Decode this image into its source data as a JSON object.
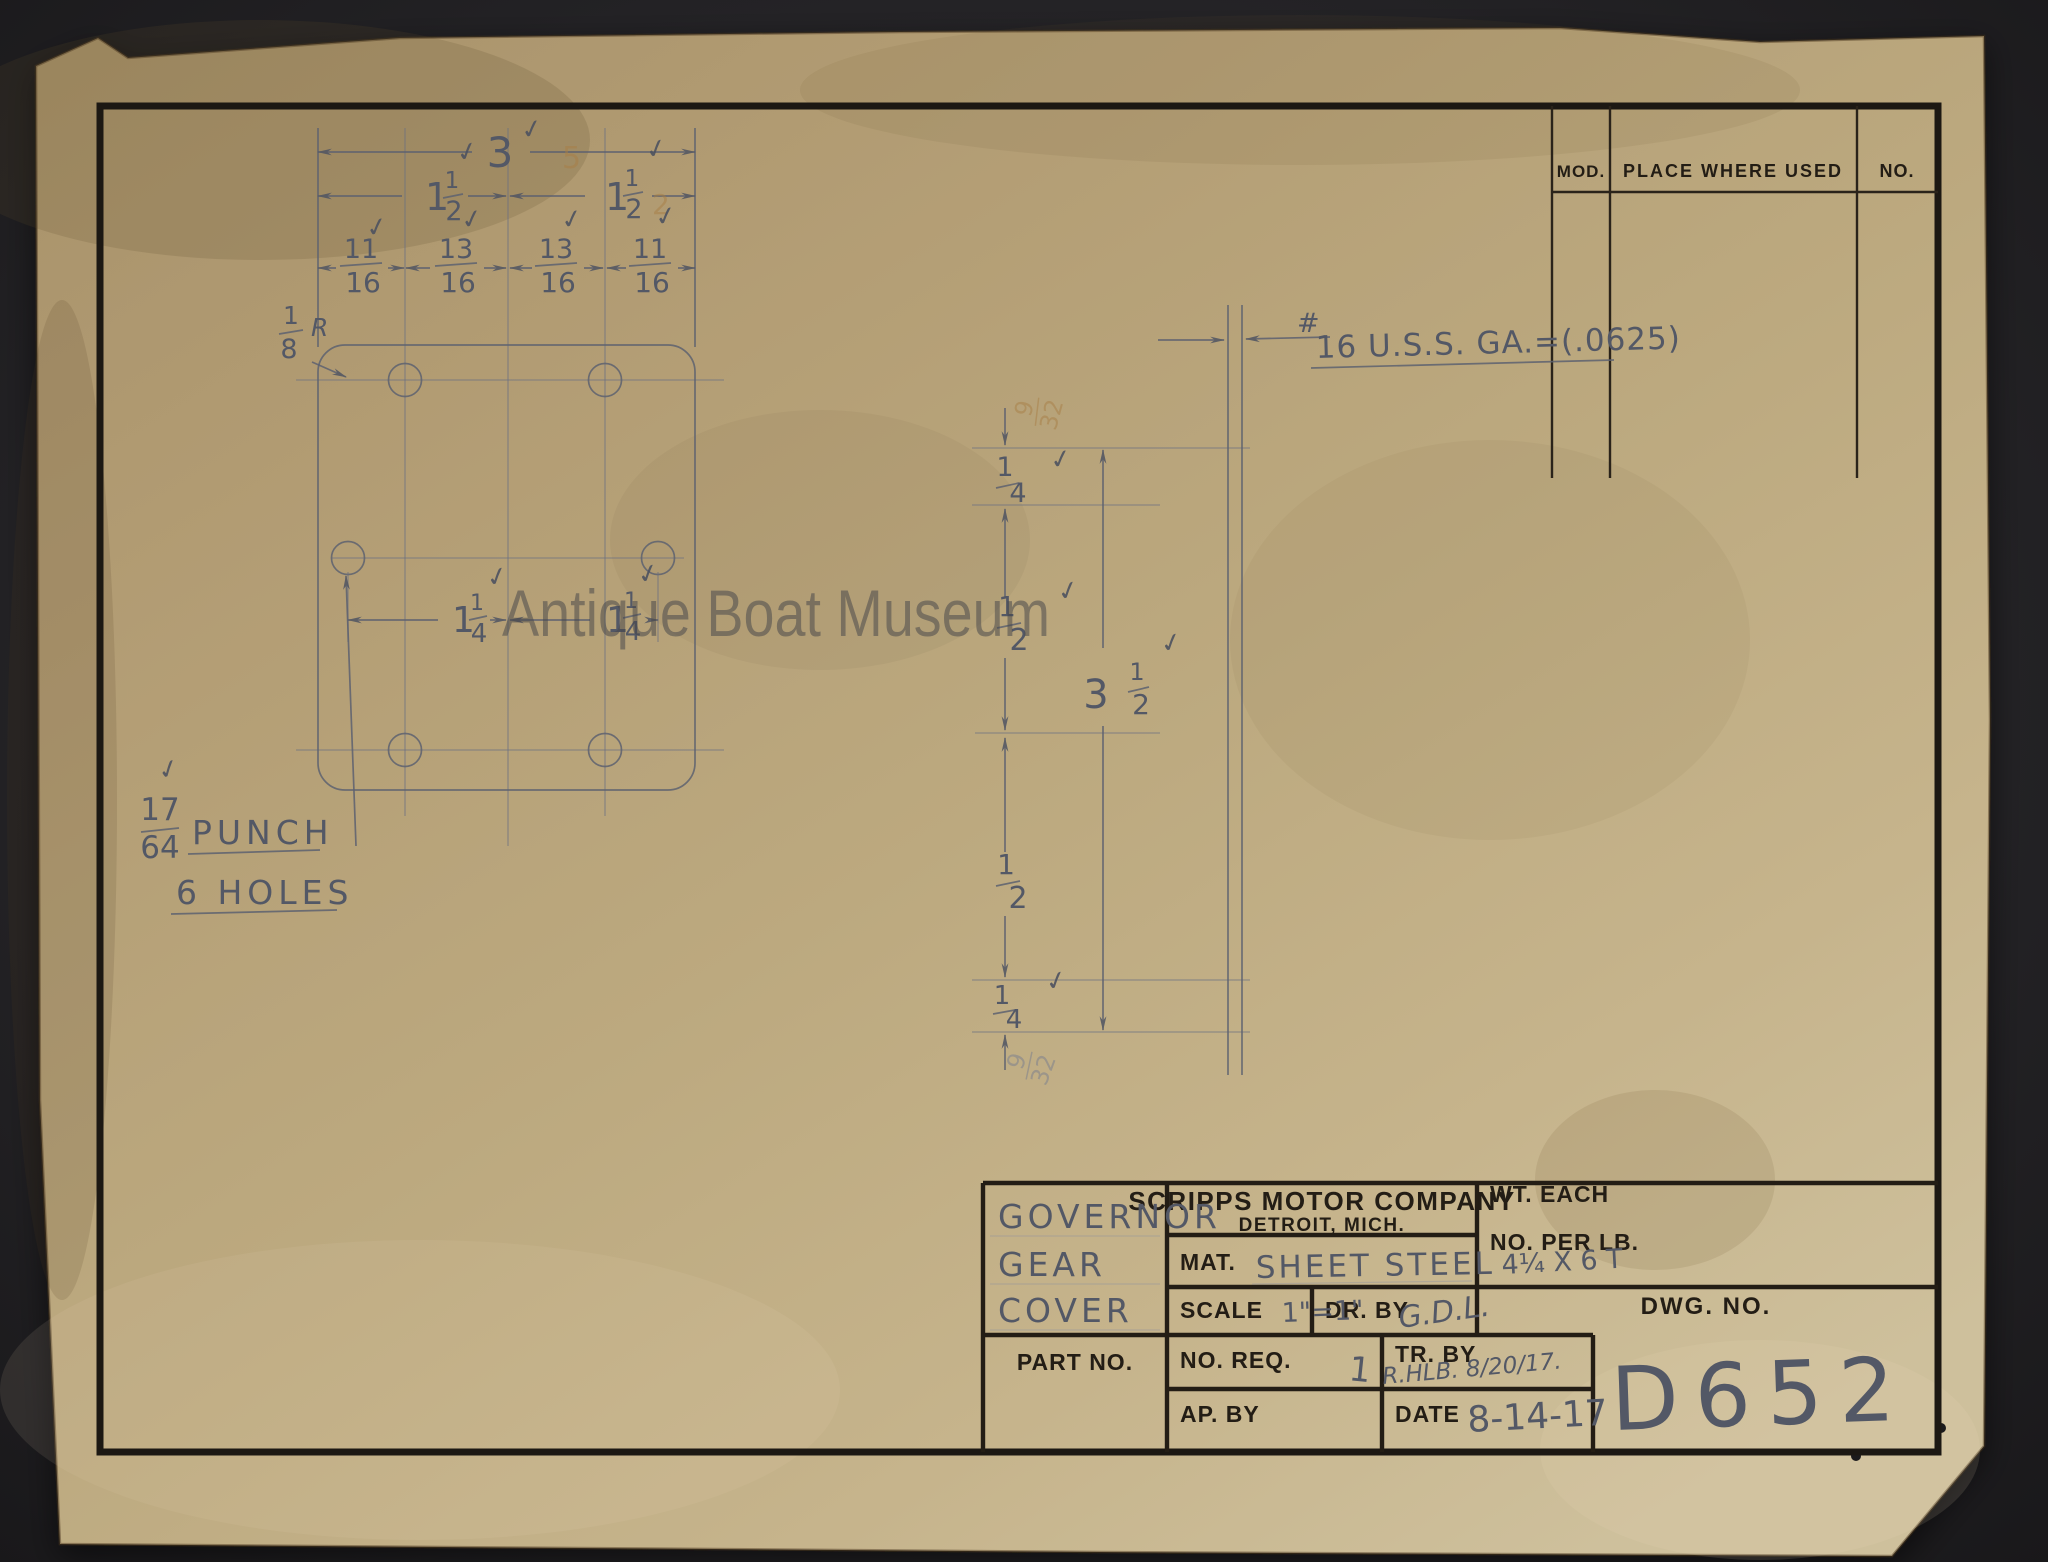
{
  "watermark": "Antique Boat Museum",
  "glyphs": {
    "check": "✓"
  },
  "drawing": {
    "dims": {
      "overall_w": "3",
      "half": {
        "whole": "1",
        "num": "1",
        "den": "2"
      },
      "sub": [
        {
          "num": "11",
          "den": "16"
        },
        {
          "num": "13",
          "den": "16"
        },
        {
          "num": "13",
          "den": "16"
        },
        {
          "num": "11",
          "den": "16"
        }
      ],
      "quarter_mixed": {
        "whole": "1",
        "num": "1",
        "den": "4"
      },
      "radius": {
        "num": "1",
        "den": "8",
        "suffix": "R"
      },
      "chain_quarter": {
        "num": "1",
        "den": "4"
      },
      "chain_half": {
        "num": "1",
        "den": "2"
      },
      "overall_h": {
        "whole": "3",
        "num": "1",
        "den": "2"
      }
    },
    "punch_note": {
      "num": "17",
      "den": "64",
      "line1": "PUNCH",
      "line2": "6 HOLES"
    },
    "gauge_note": {
      "prefix": "#",
      "text": "16 U.S.S. GA.=(.0625)"
    },
    "ghost_marks": {
      "five": "5",
      "two": "2",
      "frac_num": "9",
      "frac_den": "32"
    }
  },
  "mod_table": {
    "col_mod": "MOD.",
    "col_place": "PLACE WHERE USED",
    "col_no": "NO."
  },
  "title_block": {
    "part_name": [
      "GOVERNOR",
      "GEAR",
      "COVER"
    ],
    "company_line1": "SCRIPPS MOTOR COMPANY",
    "company_line2": "DETROIT, MICH.",
    "mat_label": "MAT.",
    "mat_value": "SHEET STEEL",
    "scale_label": "SCALE",
    "scale_value": "1\"=1\"",
    "dr_by_label": "DR. BY",
    "dr_by_value": "G.D.L.",
    "no_req_label": "NO. REQ.",
    "no_req_value": "1",
    "tr_by_label": "TR. BY",
    "tr_by_value": "R.HLB. 8/20/17.",
    "ap_by_label": "AP. BY",
    "date_label": "DATE",
    "date_value": "8-14-17",
    "part_no_label": "PART NO.",
    "wt_each_label": "WT. EACH",
    "no_per_lb_label": "NO. PER LB.",
    "size_value": "4¼ X 6 T",
    "dwg_no_label": "DWG. NO.",
    "dwg_no_value": "D652"
  }
}
